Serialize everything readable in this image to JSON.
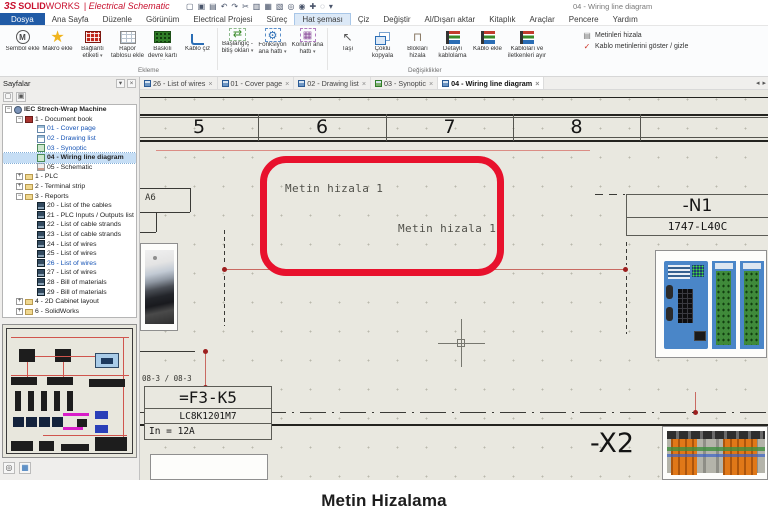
{
  "titlebar": {
    "logo_mark": "3S",
    "brand_bold": "SOLID",
    "brand_light": "WORKS",
    "product": "| Electrical Schematic",
    "window_title": "04 - Wiring line diagram",
    "qat": [
      {
        "name": "new",
        "glyph": "▢"
      },
      {
        "name": "save",
        "glyph": "▣"
      },
      {
        "name": "print",
        "glyph": "▤"
      },
      {
        "name": "undo",
        "glyph": "↶"
      },
      {
        "name": "redo",
        "glyph": "↷"
      },
      {
        "name": "cut",
        "glyph": "✂"
      },
      {
        "name": "copy",
        "glyph": "▥"
      },
      {
        "name": "paste",
        "glyph": "▦"
      },
      {
        "name": "paste-special",
        "glyph": "▧"
      },
      {
        "name": "zoom-window",
        "glyph": "◎"
      },
      {
        "name": "zoom-fit",
        "glyph": "◉"
      },
      {
        "name": "pan",
        "glyph": "✚"
      },
      {
        "name": "search",
        "glyph": "◌"
      },
      {
        "name": "options",
        "glyph": "▾"
      }
    ]
  },
  "menubar": {
    "tabs": [
      "Dosya",
      "Ana Sayfa",
      "Düzenle",
      "Görünüm",
      "Electrical Projesi",
      "Süreç",
      "Hat şeması",
      "Çiz",
      "Değiştir",
      "Al/Dışarı aktar",
      "Kitaplık",
      "Araçlar",
      "Pencere",
      "Yardım"
    ]
  },
  "ribbon": {
    "buttons": [
      {
        "label": "Sembol ekle",
        "glyph": "M"
      },
      {
        "label": "Makro ekle",
        "glyph": "★"
      },
      {
        "label": "Bağlantı etiketi",
        "glyph": ""
      },
      {
        "label": "Rapor tablosu ekle",
        "glyph": ""
      },
      {
        "label": "Baskılı devre kartı ekle",
        "glyph": ""
      },
      {
        "label": "Kablo çiz",
        "glyph": ""
      },
      {
        "label": "Başlangıç - bitiş okları",
        "glyph": "⇄"
      },
      {
        "label": "Fonksiyon ana hattı",
        "glyph": "⚙"
      },
      {
        "label": "Konum ana hattı",
        "glyph": "▦"
      },
      {
        "label": "Taşı",
        "glyph": "↖"
      },
      {
        "label": "Çoklu kopyala",
        "glyph": ""
      },
      {
        "label": "Blokları hizala",
        "glyph": "⊓"
      },
      {
        "label": "Detaylı kablolama",
        "glyph": ""
      },
      {
        "label": "Kablo ekle",
        "glyph": ""
      },
      {
        "label": "Kabloları ve iletkenleri ayır",
        "glyph": ""
      }
    ],
    "side_buttons": [
      {
        "label": "Metinleri hizala",
        "glyph": "▤"
      },
      {
        "label": "Kablo metinlerini göster / gizle",
        "glyph": "✓"
      }
    ],
    "group_labels": [
      "Ekleme",
      "Değişiklikler"
    ]
  },
  "doc_tabs": {
    "tabs": [
      {
        "label": "26 - List of wires"
      },
      {
        "label": "01 - Cover page"
      },
      {
        "label": "02 - Drawing list"
      },
      {
        "label": "03 - Synoptic"
      },
      {
        "label": "04 - Wiring line diagram"
      }
    ]
  },
  "glyphs": {
    "close": "×",
    "tab_prev": "◂",
    "tab_next": "▸",
    "pin": "▾",
    "page_tool": "▢",
    "clip_tool": "▣",
    "zoom_tool": "◎",
    "grid_tool": "▦"
  },
  "sidebar": {
    "title": "Sayfalar",
    "tree": [
      {
        "label": "IEC Strech-Wrap Machine"
      },
      {
        "label": "1 - Document book"
      },
      {
        "label": "01 - Cover page"
      },
      {
        "label": "02 - Drawing list"
      },
      {
        "label": "03 - Synoptic"
      },
      {
        "label": "04 - Wiring line diagram"
      },
      {
        "label": "05 - Schematic"
      },
      {
        "label": "1 - PLC"
      },
      {
        "label": "2 - Terminal strip"
      },
      {
        "label": "3 - Reports"
      },
      {
        "label": "20 - List of the cables"
      },
      {
        "label": "21 - PLC Inputs / Outputs list"
      },
      {
        "label": "22 - List of cable strands"
      },
      {
        "label": "23 - List of cable strands"
      },
      {
        "label": "24 - List of wires"
      },
      {
        "label": "25 - List of wires"
      },
      {
        "label": "26 - List of wires"
      },
      {
        "label": "27 - List of wires"
      },
      {
        "label": "28 - Bill of materials"
      },
      {
        "label": "29 - Bill of materials"
      },
      {
        "label": "4 - 2D Cabinet layout"
      },
      {
        "label": "6 - SolidWorks"
      }
    ]
  },
  "canvas": {
    "columns": [
      "5",
      "6",
      "7",
      "8"
    ],
    "annotation_color": "#e8112d",
    "wire_color": "#c96a62",
    "texts": {
      "align1": "Metin hizala 1",
      "align2": "Metin hizala 1",
      "a6": "A6",
      "xref": "08-3 / 08-3",
      "k5_tag": "=F3-K5",
      "k5_ref": "LC8K1201M7",
      "k5_in": "In = 12A",
      "n1_tag": "-N1",
      "n1_ref": "1747-L40C",
      "x2_tag": "-X2"
    }
  },
  "caption": {
    "text": "Metin Hizalama"
  }
}
